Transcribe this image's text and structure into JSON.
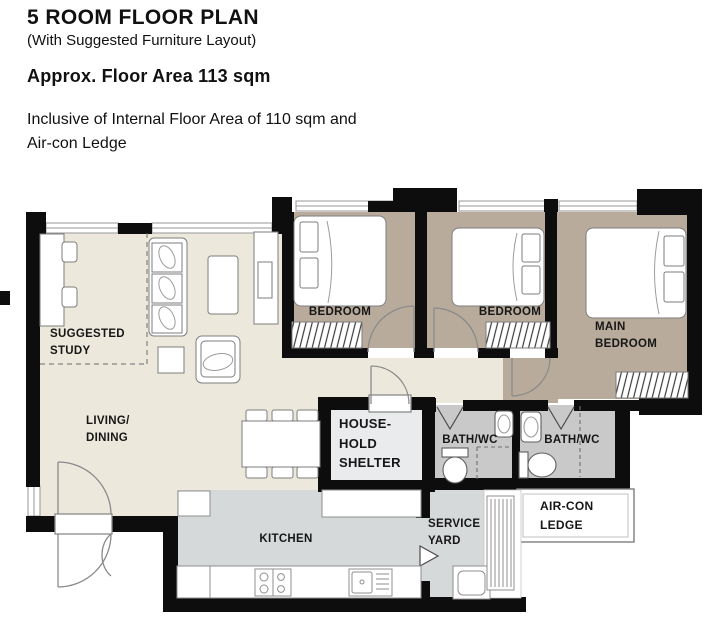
{
  "header": {
    "title": "5 ROOM FLOOR PLAN",
    "subtitle": "(With Suggested Furniture Layout)",
    "area": "Approx. Floor Area 113 sqm",
    "note": "Inclusive of Internal Floor Area of 110 sqm and\nAir-con Ledge"
  },
  "rooms": {
    "suggested_study": "SUGGESTED\nSTUDY",
    "living_dining": "LIVING/\nDINING",
    "bedroom1": "BEDROOM",
    "bedroom2": "BEDROOM",
    "main_bedroom": "MAIN\nBEDROOM",
    "household_shelter": "HOUSE-\nHOLD\nSHELTER",
    "bath1": "BATH/WC",
    "bath2": "BATH/WC",
    "aircon_ledge": "AIR-CON\nLEDGE",
    "kitchen": "KITCHEN",
    "service_yard": "SERVICE\nYARD"
  },
  "colors": {
    "living_floor": "#ece9dc",
    "bedroom_floor": "#b8ab9b",
    "kitchen_floor": "#d6d9da",
    "bath_floor": "#c9c9c9",
    "shelter_floor": "#e9ebed",
    "wall": "#0d0d0d"
  }
}
